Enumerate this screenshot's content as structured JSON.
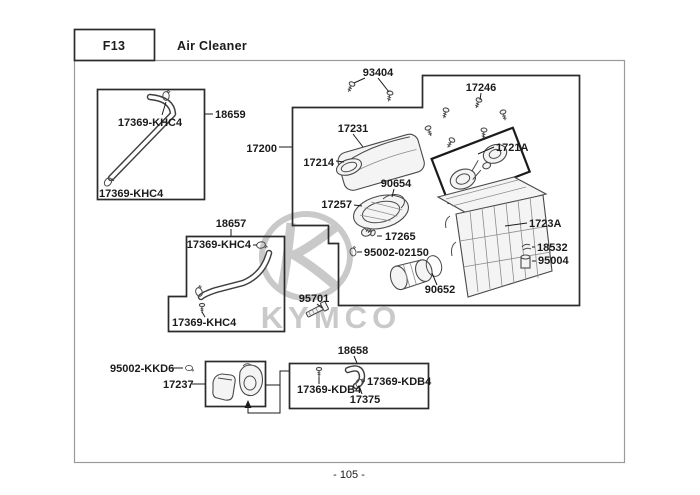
{
  "header": {
    "section_code": "F13",
    "section_title": "Air Cleaner"
  },
  "footer": {
    "page_number": "- 105 -"
  },
  "watermark": {
    "brand": "KYMCO"
  },
  "colors": {
    "line": "#1b1b1b",
    "box_border": "#2b2b2b",
    "page_border": "#9a9a9a",
    "watermark": "#c9c9c9"
  },
  "parts": {
    "p93404": "93404",
    "p17246": "17246",
    "p17231": "17231",
    "p17200": "17200",
    "p17214": "17214",
    "p1721a": "1721A",
    "p90654": "90654",
    "p17257": "17257",
    "p17265": "17265",
    "p95002_02150": "95002-02150",
    "p1723a": "1723A",
    "p18532": "18532",
    "p95004": "95004",
    "p90652": "90652",
    "p18659": "18659",
    "p17369_khc4_a": "17369-KHC4",
    "p17369_khc4_b": "17369-KHC4",
    "p18657": "18657",
    "p17369_khc4_c": "17369-KHC4",
    "p17369_khc4_d": "17369-KHC4",
    "p95701": "95701",
    "p18658": "18658",
    "p95002_kkd6": "95002-KKD6",
    "p17237": "17237",
    "p17369_kdb4_a": "17369-KDB4",
    "p17369_kdb4_b": "17369-KDB4",
    "p17375": "17375"
  }
}
